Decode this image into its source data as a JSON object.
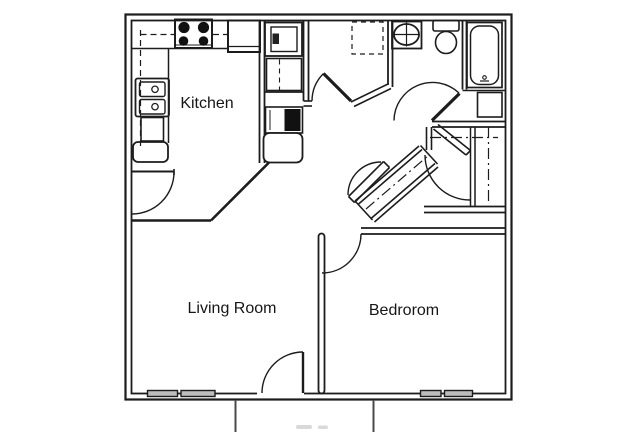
{
  "floor_plan": {
    "title": "one-bedroom apartment floor plan",
    "rooms": [
      {
        "label": "Kitchen"
      },
      {
        "label": "Living Room"
      },
      {
        "label": "Bedrorom"
      }
    ],
    "fixtures": [
      "stove-4-burner",
      "refrigerator",
      "double-basin-sink",
      "dishwasher",
      "upper-cabinet-dashed-lines",
      "washer-box",
      "utility-cabinet",
      "water-heater-black",
      "washer-dryer-dashed-alcove",
      "vanity-sink-with-cross",
      "toilet",
      "bathtub",
      "linen-shelf",
      "walk-in-closet-rods-dashdot",
      "diagonal-hall-closet",
      "door-swing-arcs",
      "windows",
      "patio-rails"
    ],
    "colors": {
      "line": "#1c1c1c",
      "window_fill": "#bdbdbd",
      "appliance_dark": "#111111",
      "patio_line": "#4a4a4a",
      "background": "#ffffff"
    }
  }
}
